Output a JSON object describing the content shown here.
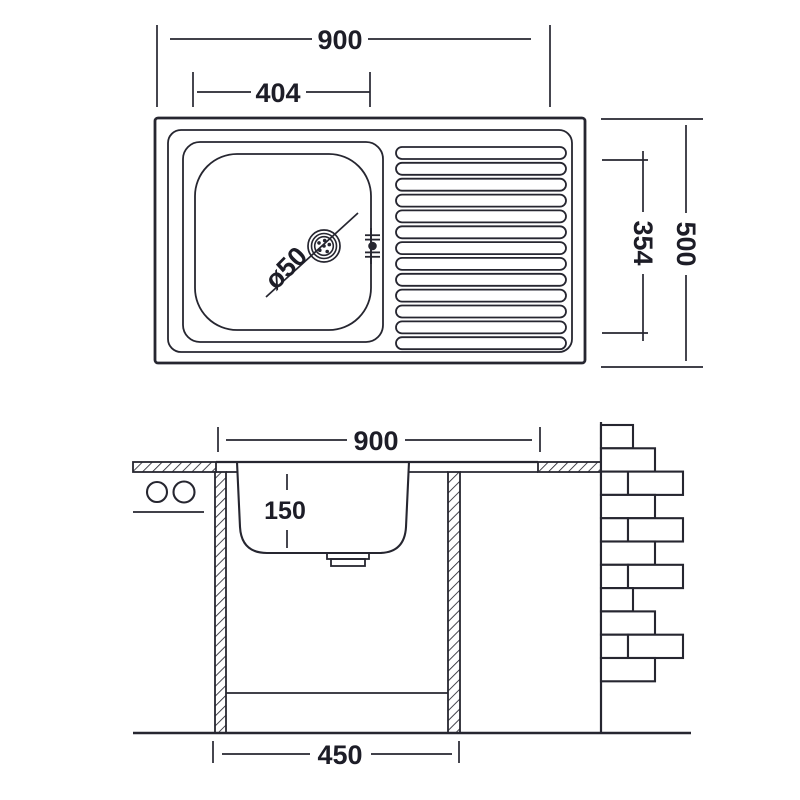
{
  "drawing": {
    "type": "sink technical drawing",
    "colors": {
      "ink": "#262630",
      "background": "#ffffff"
    }
  },
  "top_view": {
    "overall_width_label": "900",
    "bowl_width_label": "404",
    "overall_depth_label": "500",
    "inner_depth_label": "354",
    "drain_diameter_label": "ø50",
    "drainboard_rib_count": 13
  },
  "section_view": {
    "overall_width_label": "900",
    "bowl_depth_label": "150",
    "cabinet_width_label": "450"
  }
}
